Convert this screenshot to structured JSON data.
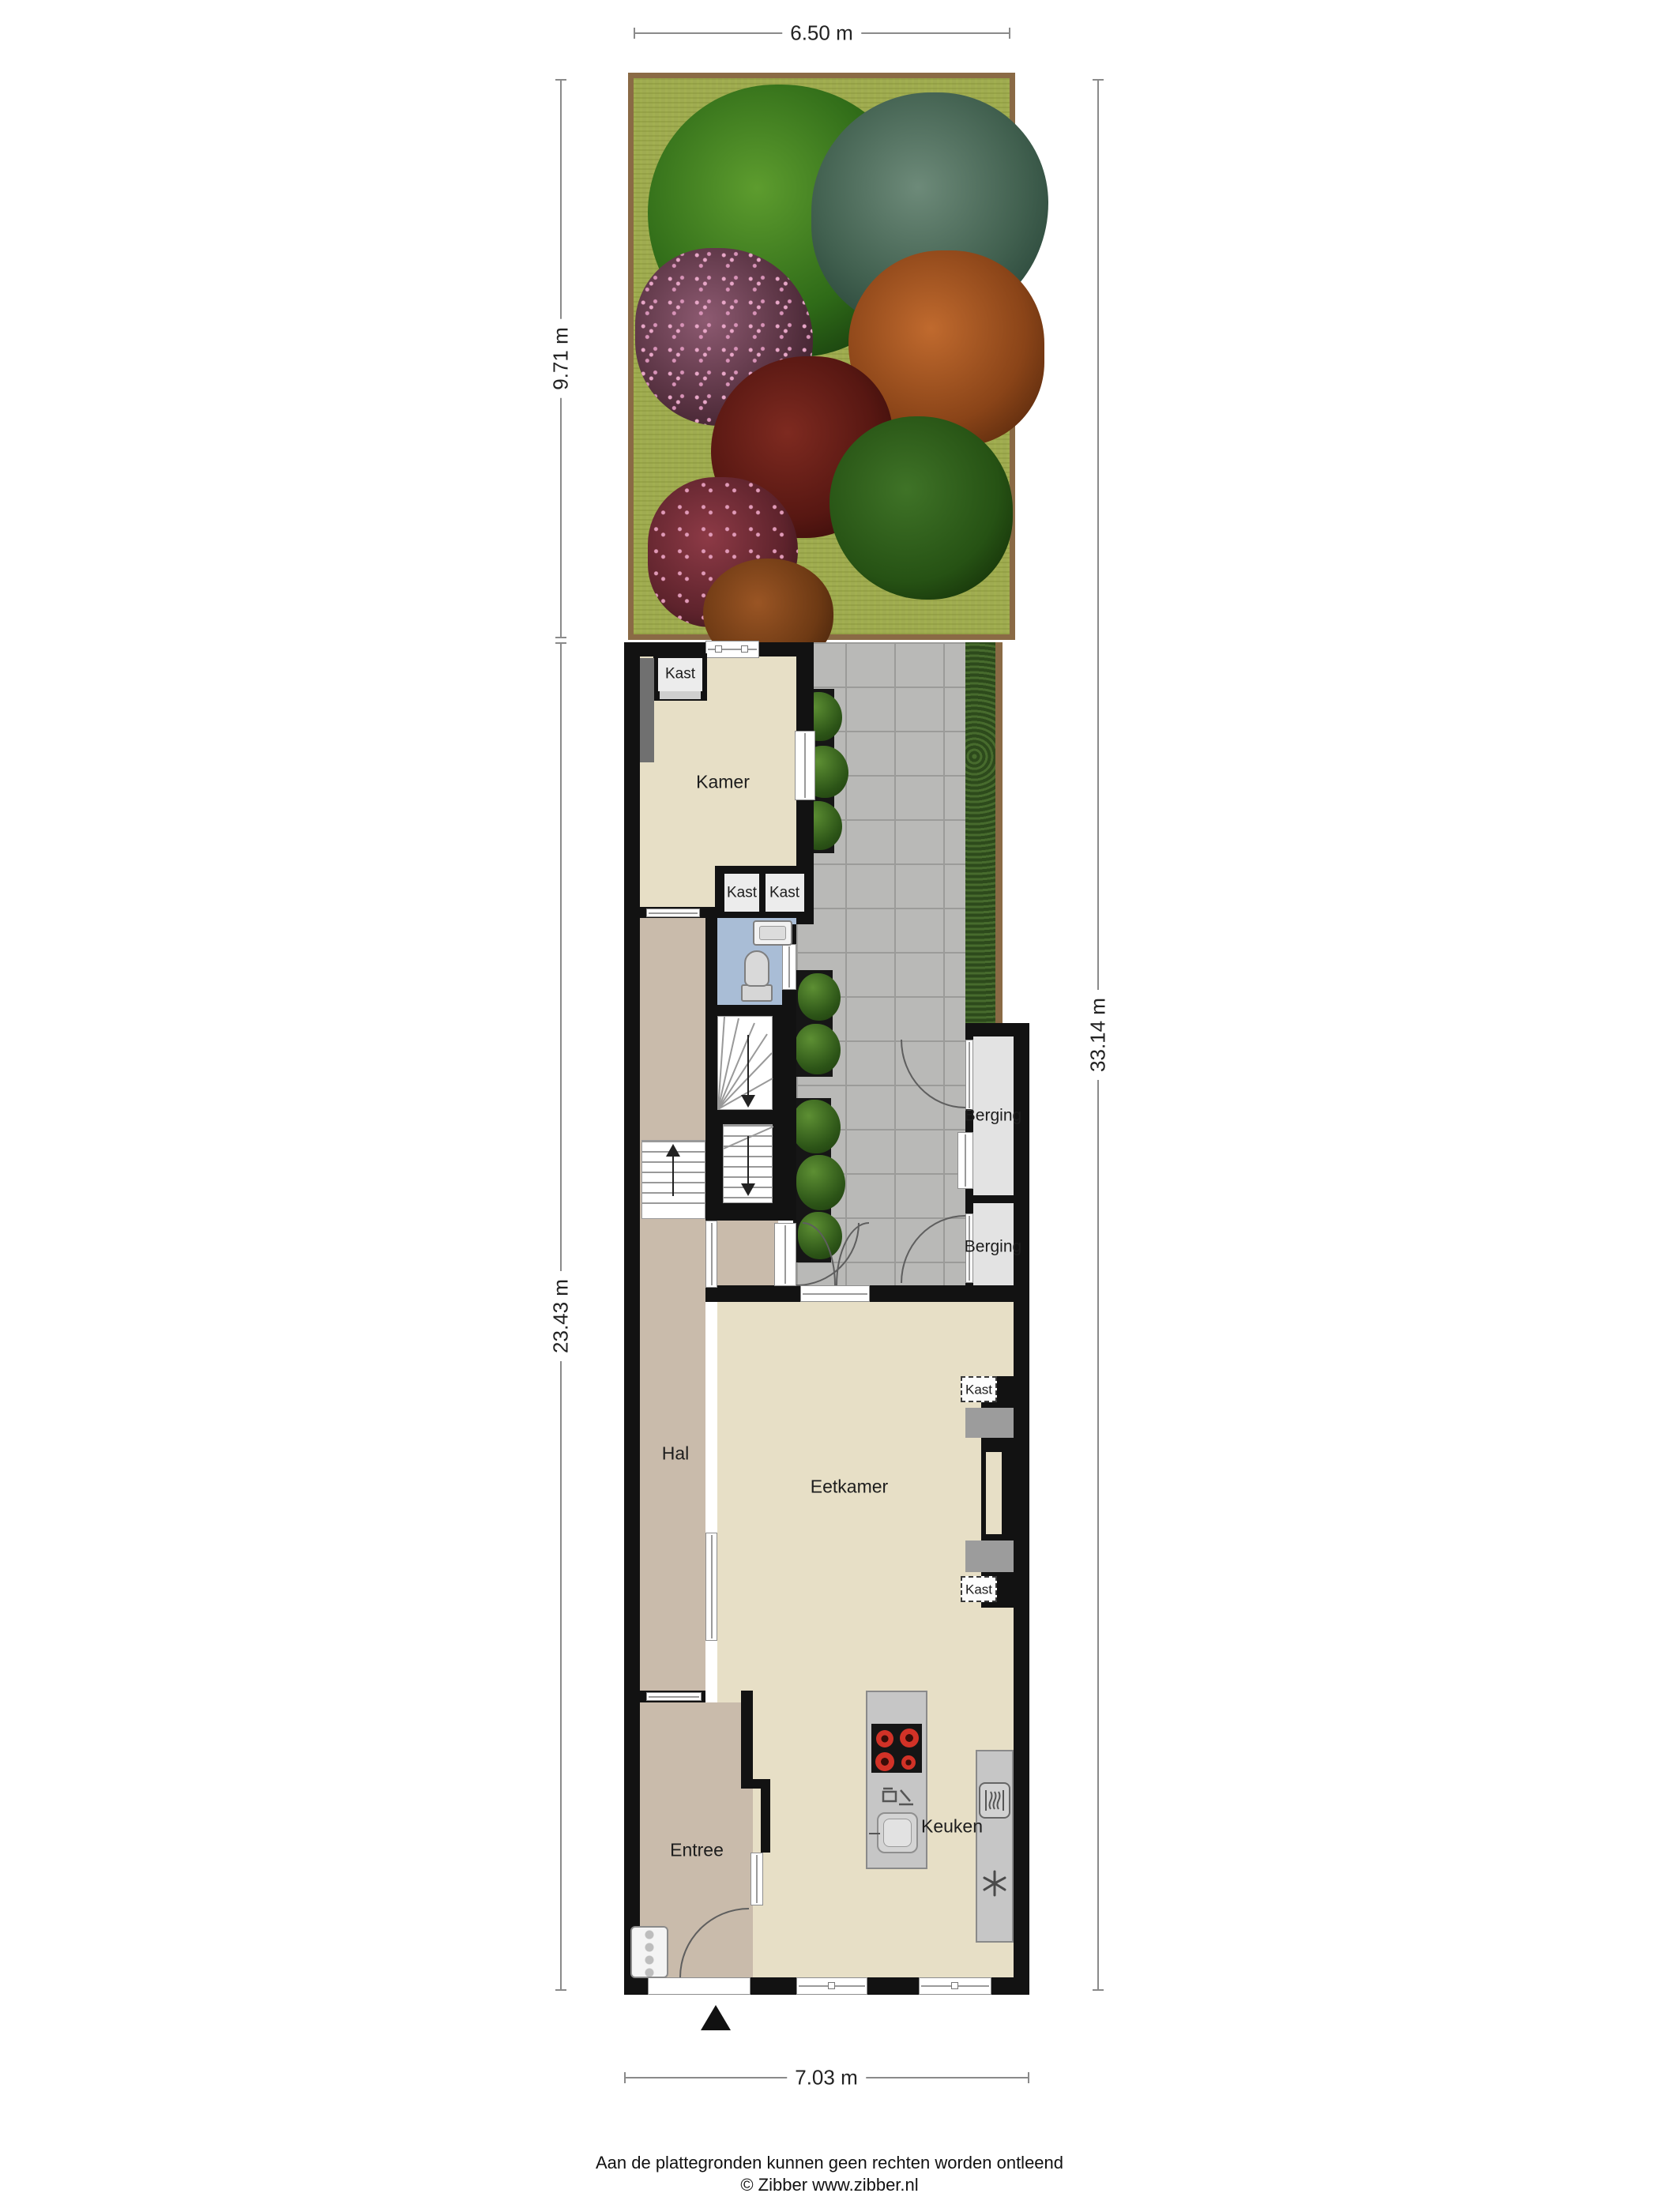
{
  "title": "Floor plan situatie - begane grond met tuin",
  "dimensions": {
    "top": "6.50 m",
    "garden_left": "9.71 m",
    "house_left": "23.43 m",
    "right": "33.14 m",
    "bottom": "7.03 m"
  },
  "rooms": {
    "kamer": "Kamer",
    "kamer_closet": "Kast",
    "hall_closet_left": "Kast",
    "hall_closet_right": "Kast",
    "storage_top": "Berging",
    "storage_bottom": "Berging",
    "hall": "Hal",
    "dining_room": "Eetkamer",
    "chimney_closet_top": "Kast",
    "chimney_closet_bottom": "Kast",
    "entrance": "Entree",
    "kitchen": "Keuken"
  },
  "footer": {
    "line1": "Aan de plattegronden kunnen geen rechten worden ontleend",
    "line2": "© Zibber www.zibber.nl"
  },
  "colors": {
    "wall": "#121212",
    "floor_main": "#e7dfc6",
    "floor_hall": "#c9bbab",
    "floor_toilet": "#a9bdd6",
    "floor_storage": "#e3e3e3",
    "terrace": "#b9b9b7",
    "grass": "#9fab51",
    "hedge": "#2d4a1c",
    "fence": "#8a6a45",
    "kitchen_counter": "#c6c6c6",
    "burner_red": "#d23227"
  },
  "icons": {
    "cooktop": "cooktop-icon",
    "dishwasher": "dishwasher-icon",
    "kitchen_sink": "sink-icon",
    "oven": "oven-icon",
    "extractor_fan": "extractor-fan-icon",
    "toilet": "toilet-icon",
    "washbasin": "washbasin-icon",
    "radiator": "radiator-icon",
    "entrance_marker": "entrance-marker-icon"
  }
}
